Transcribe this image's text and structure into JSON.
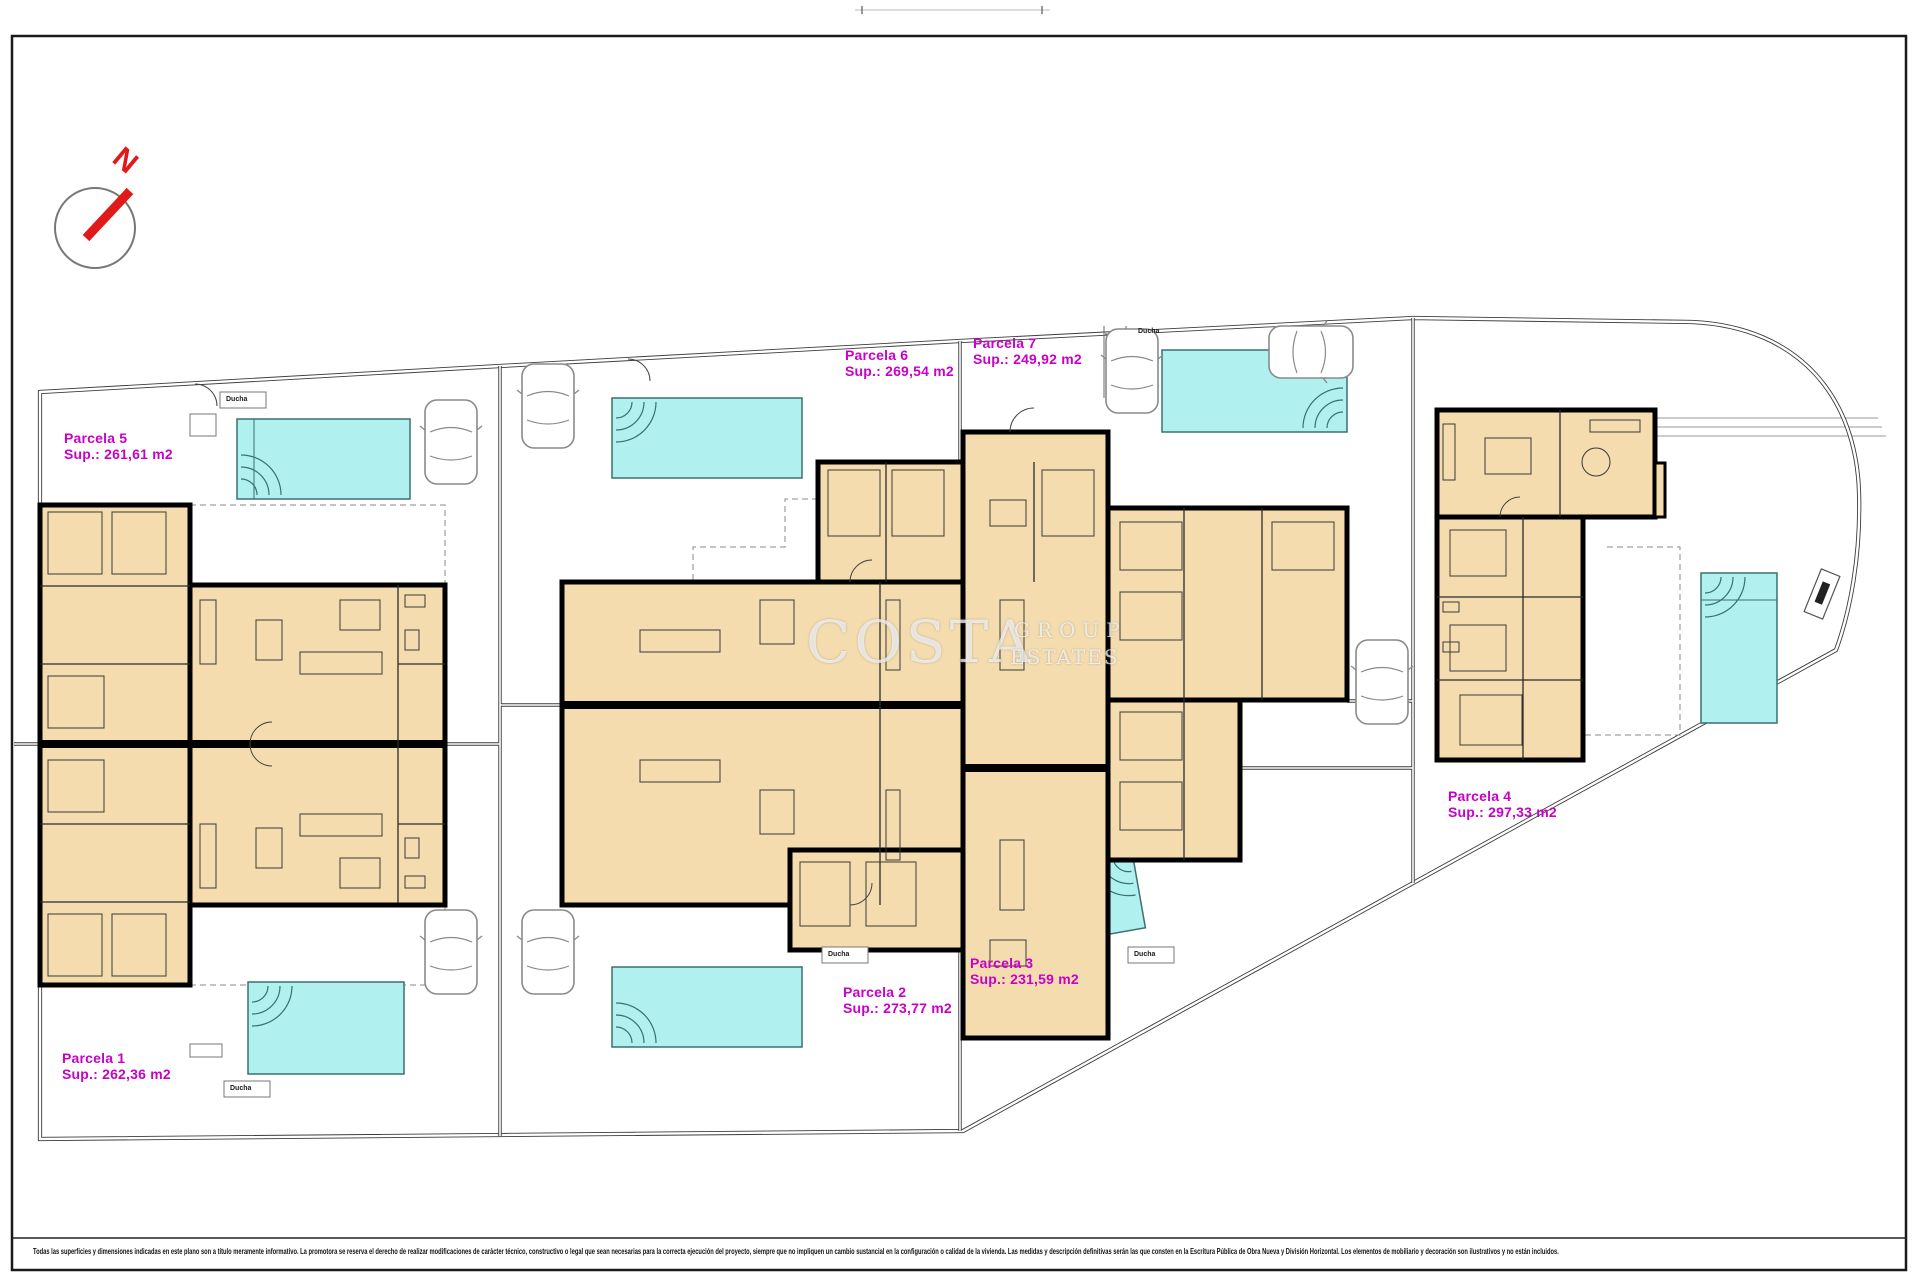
{
  "plan": {
    "compass_label": "N",
    "watermark": {
      "primary": "COSTA",
      "secondary_top": "GROUP",
      "secondary_bottom": "ESTATES"
    },
    "shower_label": "Ducha",
    "parcels": [
      {
        "name": "Parcela 1",
        "sup": "Sup.: 262,36 m2"
      },
      {
        "name": "Parcela 2",
        "sup": "Sup.: 273,77 m2"
      },
      {
        "name": "Parcela 3",
        "sup": "Sup.: 231,59 m2"
      },
      {
        "name": "Parcela 4",
        "sup": "Sup.: 297,33 m2"
      },
      {
        "name": "Parcela 5",
        "sup": "Sup.: 261,61 m2"
      },
      {
        "name": "Parcela 6",
        "sup": "Sup.: 269,54 m2"
      },
      {
        "name": "Parcela 7",
        "sup": "Sup.: 249,92 m2"
      }
    ],
    "disclaimer": "Todas las superficies y dimensiones indicadas en este plano son a título meramente informativo. La promotora se reserva el derecho de realizar modificaciones de carácter técnico, constructivo o legal que sean necesarias para la correcta ejecución del proyecto, siempre que no impliquen un cambio sustancial en la configuración o calidad de la vivienda. Las medidas y descripción definitivas serán las que consten en la Escritura Pública de Obra Nueva y División Horizontal. Los elementos de mobiliario y decoración son ilustrativos y no están incluidos."
  },
  "colors": {
    "parcel_label_magenta": "#c800c8",
    "pool_fill": "#b0f0ee",
    "pool_stroke": "#3a7070",
    "building_fill": "#f4dcae",
    "wall_black": "#000000",
    "compass_red": "#e11919"
  }
}
